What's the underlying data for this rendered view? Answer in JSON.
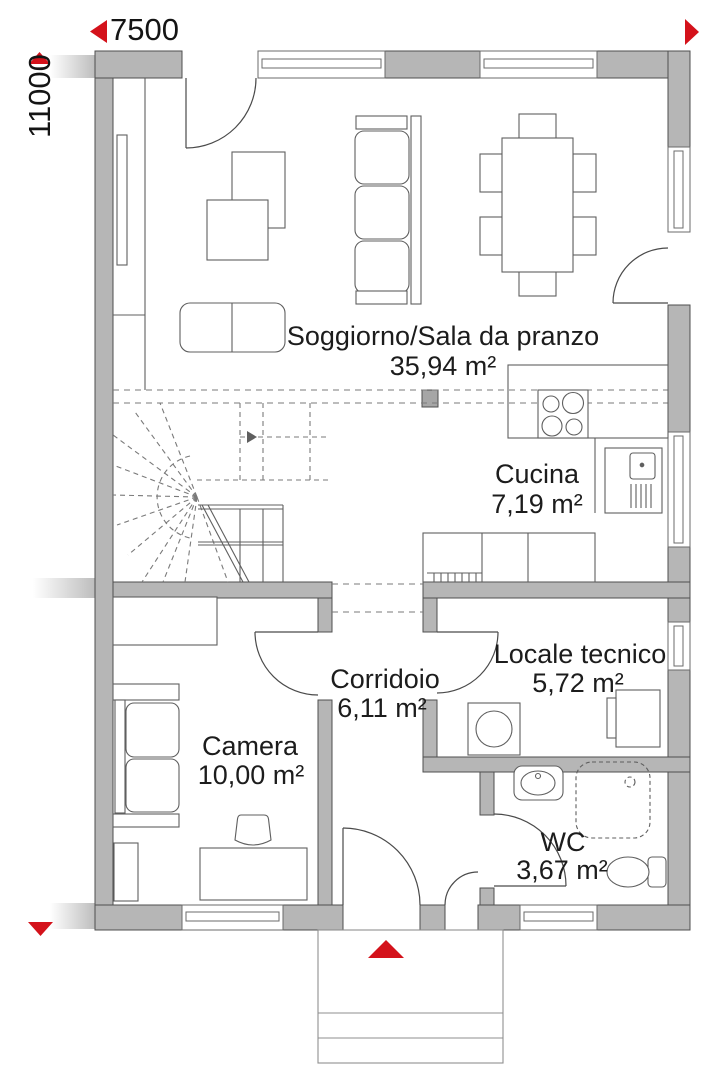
{
  "plan": {
    "type": "floor-plan",
    "language": "it"
  },
  "colors": {
    "wall_fill": "#b6b6b6",
    "wall_stroke": "#4f4f4f",
    "furniture_stroke": "#5f5f5f",
    "dashed_stroke": "#7a7a7a",
    "accent_red": "#d4121b",
    "text": "#1c1c1c"
  },
  "dimensions": {
    "width_label": "7500",
    "height_label": "11000"
  },
  "markers": {
    "entrance_icon": "up-arrow",
    "width_arrows": [
      "left-arrow",
      "right-arrow"
    ],
    "height_arrows": [
      "up-arrow",
      "down-arrow"
    ]
  },
  "rooms": {
    "soggiorno": {
      "name": "Soggiorno/Sala da pranzo",
      "area": "35,94 m²"
    },
    "cucina": {
      "name": "Cucina",
      "area": "7,19 m²"
    },
    "corridoio": {
      "name": "Corridoio",
      "area": "6,11 m²"
    },
    "locale_tecnico": {
      "name": "Locale tecnico",
      "area": "5,72 m²"
    },
    "camera": {
      "name": "Camera",
      "area": "10,00 m²"
    },
    "wc": {
      "name": "WC",
      "area": "3,67 m²"
    }
  }
}
